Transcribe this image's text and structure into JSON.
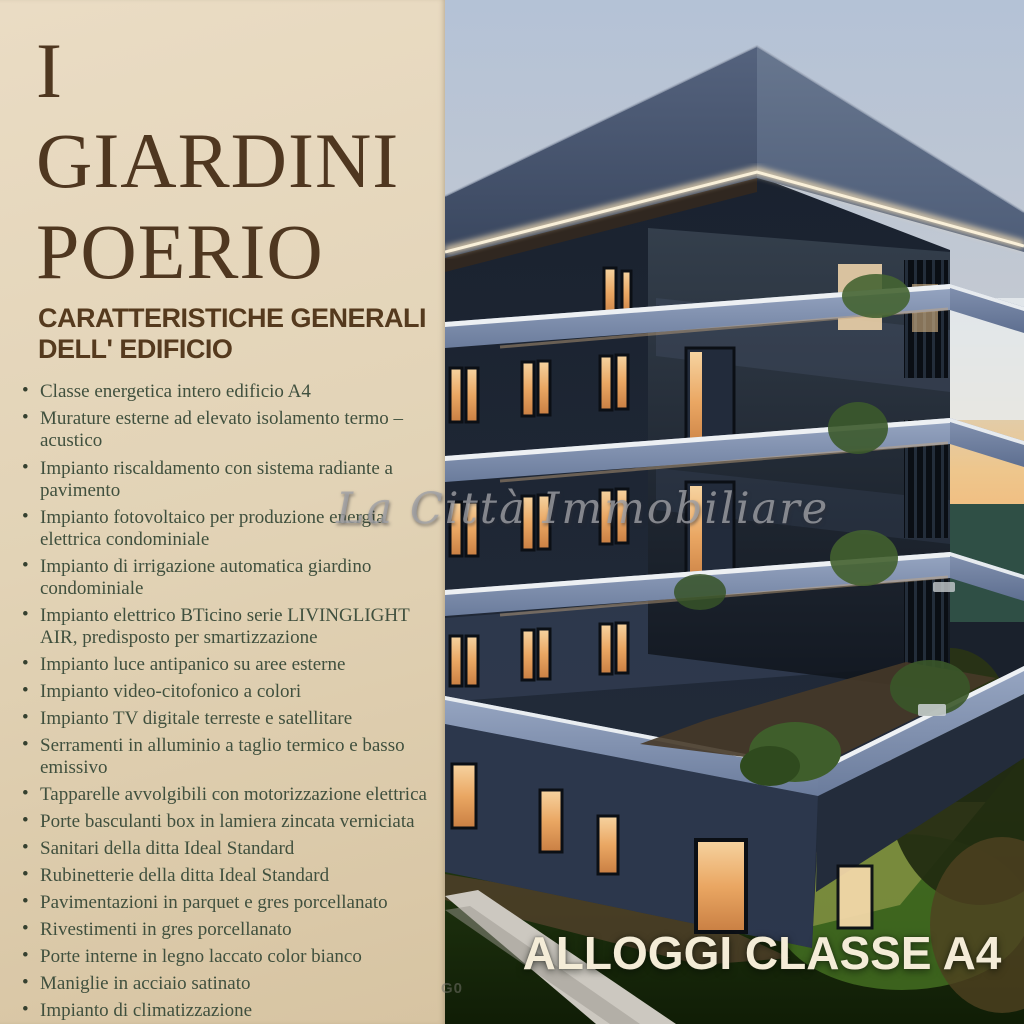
{
  "flyer": {
    "title_line1": "I GIARDINI",
    "title_line2": "POERIO",
    "heading_line1": "CARATTERISTICHE GENERALI",
    "heading_line2": "DELL' EDIFICIO",
    "features": [
      "Classe energetica intero edificio A4",
      "Murature esterne ad elevato isolamento termo – acustico",
      "Impianto riscaldamento con sistema radiante a pavimento",
      "Impianto fotovoltaico per produzione energia elettrica condominiale",
      "Impianto di irrigazione automatica giardino condominiale",
      "Impianto elettrico BTicino serie LIVINGLIGHT AIR, predisposto per smartizzazione",
      "Impianto luce antipanico su aree esterne",
      "Impianto video-citofonico a colori",
      "Impianto TV digitale terreste e satellitare",
      "Serramenti in alluminio a taglio termico e basso emissivo",
      "Tapparelle avvolgibili con motorizzazione elettrica",
      "Porte basculanti box in lamiera zincata verniciata",
      "Sanitari della ditta Ideal Standard",
      "Rubinetterie della ditta Ideal Standard",
      "Pavimentazioni in parquet e gres porcellanato",
      "Rivestimenti in gres porcellanato",
      "Porte interne in legno laccato color bianco",
      "Maniglie in acciaio satinato",
      "Impianto di climatizzazione"
    ]
  },
  "render": {
    "watermark": "La Città Immobiliare",
    "caption": "ALLOGGI CLASSE A4",
    "corner_mark": "G0"
  },
  "colors": {
    "panel_bg": "#e2d3b6",
    "title_text": "#4f3720",
    "heading_text": "#553a1e",
    "feature_text": "#40503e",
    "caption_text": "#f4ecd7",
    "sky_top": "#b4c2d6",
    "sunset_orange": "#f2ba7c",
    "teal_band": "#2f4f45",
    "facade_dark": "#1b2330",
    "slab_blue": "#8b9cba",
    "window_glow": "#e8a964",
    "grass_dark": "#1d3110",
    "grass_light": "#4d7d26"
  }
}
